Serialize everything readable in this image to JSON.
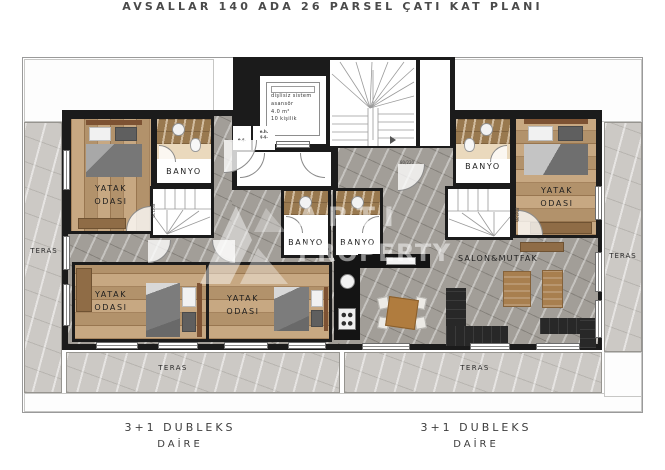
{
  "title": "AVSALLAR 140 ADA 26 PARSEL ÇATI KAT PLANI",
  "watermark": {
    "line1": "ARTI",
    "line2": "PROPERTY"
  },
  "core": {
    "elevator": {
      "line1": "dişlisiz sistem",
      "line2": "asansör",
      "line3": "4.0 m²",
      "line4": "10 kişilik"
    },
    "shaft_left": "e.ş.",
    "shaft_right_line1": "e.h.",
    "shaft_right_line2": "ş.ş."
  },
  "left_apartment": {
    "bedroom_top": {
      "line1": "YATAK",
      "line2": "ODASI"
    },
    "bathroom": "BANYO",
    "bathroom_mid": "BANYO",
    "bedroom_bottom_left": {
      "line1": "YATAK",
      "line2": "ODASI"
    },
    "bedroom_bottom_mid": {
      "line1": "YATAK",
      "line2": "ODASI"
    },
    "label": {
      "line1": "3+1 DUBLEKS",
      "line2": "DAİRE"
    }
  },
  "right_apartment": {
    "bathroom": "BANYO",
    "bathroom_mid": "BANYO",
    "bedroom": {
      "line1": "YATAK",
      "line2": "ODASI"
    },
    "living": "SALON&MUTFAK",
    "label": {
      "line1": "3+1 DUBLEKS",
      "line2": "DAİRE"
    }
  },
  "terraces": {
    "left": "TERAS",
    "right": "TERAS",
    "bottom_left": "TERAS",
    "bottom_right": "TERAS"
  },
  "door_label": "80/220",
  "colors": {
    "wall": "#1b1b1b",
    "wood_floor": "#c19e74",
    "interior_marble": "#a29e98",
    "terrace_marble": "#ccc9c5",
    "bath_tile": "#99794f"
  }
}
